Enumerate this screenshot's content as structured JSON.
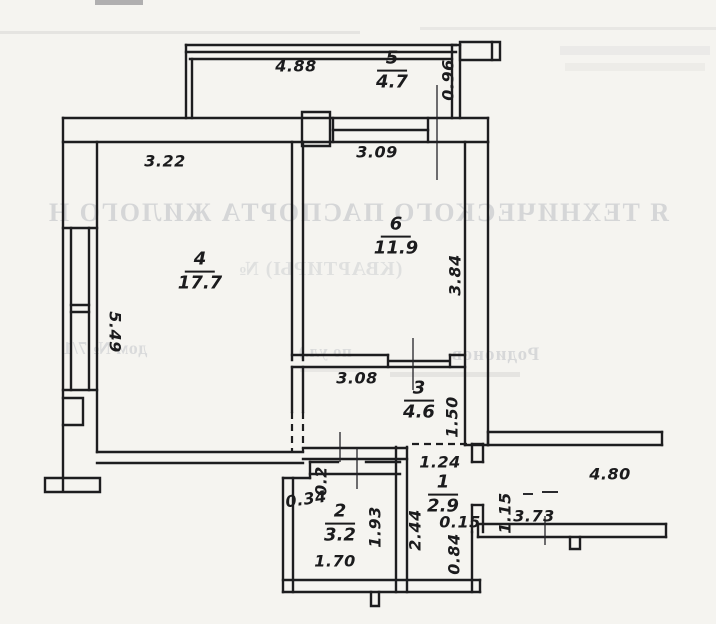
{
  "meta": {
    "background_color": "#f5f4f0",
    "ink_color": "#1d1d1f",
    "ghost_color": "#8d93a0",
    "drawing_type": "apartment floor plan (scanned)"
  },
  "rooms": [
    {
      "num": "5",
      "area": "4.7"
    },
    {
      "num": "4",
      "area": "17.7"
    },
    {
      "num": "6",
      "area": "11.9"
    },
    {
      "num": "3",
      "area": "4.6"
    },
    {
      "num": "1",
      "area": "2.9"
    },
    {
      "num": "2",
      "area": "3.2"
    }
  ],
  "room_labels": [
    {
      "num": "5",
      "area": "4.7",
      "x": 392,
      "y": 71
    },
    {
      "num": "4",
      "area": "17.7",
      "x": 200,
      "y": 272
    },
    {
      "num": "6",
      "area": "11.9",
      "x": 396,
      "y": 237
    },
    {
      "num": "3",
      "area": "4.6",
      "x": 419,
      "y": 401
    },
    {
      "num": "1",
      "area": "2.9",
      "x": 443,
      "y": 495
    },
    {
      "num": "2",
      "area": "3.2",
      "x": 340,
      "y": 524
    }
  ],
  "dim_labels": [
    {
      "text": "4.88",
      "x": 296,
      "y": 66,
      "rot": 0
    },
    {
      "text": "0.96",
      "x": 448,
      "y": 80,
      "rot": -90
    },
    {
      "text": "3.22",
      "x": 165,
      "y": 161,
      "rot": 0
    },
    {
      "text": "3.09",
      "x": 377,
      "y": 152,
      "rot": 0
    },
    {
      "text": "3.84",
      "x": 455,
      "y": 275,
      "rot": -90
    },
    {
      "text": "5.49",
      "x": 115,
      "y": 332,
      "rot": 90
    },
    {
      "text": "3.08",
      "x": 357,
      "y": 378,
      "rot": 0
    },
    {
      "text": "1.50",
      "x": 452,
      "y": 417,
      "rot": -90
    },
    {
      "text": "1.24",
      "x": 440,
      "y": 462,
      "rot": 0
    },
    {
      "text": "4.80",
      "x": 610,
      "y": 474,
      "rot": 0
    },
    {
      "text": "2.44",
      "x": 415,
      "y": 530,
      "rot": -90
    },
    {
      "text": "0.15",
      "x": 460,
      "y": 522,
      "rot": 0
    },
    {
      "text": "0.84",
      "x": 454,
      "y": 554,
      "rot": -90
    },
    {
      "text": "1.15",
      "x": 505,
      "y": 513,
      "rot": -90
    },
    {
      "text": "3.73",
      "x": 534,
      "y": 516,
      "rot": 0
    },
    {
      "text": "0.2",
      "x": 321,
      "y": 481,
      "rot": -90
    },
    {
      "text": "0.34",
      "x": 306,
      "y": 499,
      "rot": -8
    },
    {
      "text": "1.93",
      "x": 375,
      "y": 527,
      "rot": -90
    },
    {
      "text": "1.70",
      "x": 335,
      "y": 561,
      "rot": 0
    }
  ],
  "ghost_fragments": [
    {
      "text": "Я ТЕХНИЧЕСКОГО ПАСПОРТА ЖИЛОГО Н",
      "x": -10,
      "y": 198,
      "w": 736,
      "size": 26,
      "spacing": 2,
      "opacity": 0.3,
      "align": "center"
    },
    {
      "text": "(КВАРТИРЫ) №",
      "x": 160,
      "y": 258,
      "w": 320,
      "size": 20,
      "spacing": 1,
      "opacity": 0.2,
      "align": "center"
    },
    {
      "text": "дом № 7/1",
      "x": 35,
      "y": 338,
      "w": 140,
      "size": 18,
      "spacing": 0.5,
      "opacity": 0.26,
      "align": "center"
    },
    {
      "text": "по ул.)",
      "x": 280,
      "y": 342,
      "w": 90,
      "size": 17,
      "spacing": 0.5,
      "opacity": 0.24,
      "align": "center"
    },
    {
      "text": "Родионов",
      "x": 420,
      "y": 344,
      "w": 150,
      "size": 19,
      "spacing": 1,
      "opacity": 0.28,
      "align": "center"
    }
  ]
}
